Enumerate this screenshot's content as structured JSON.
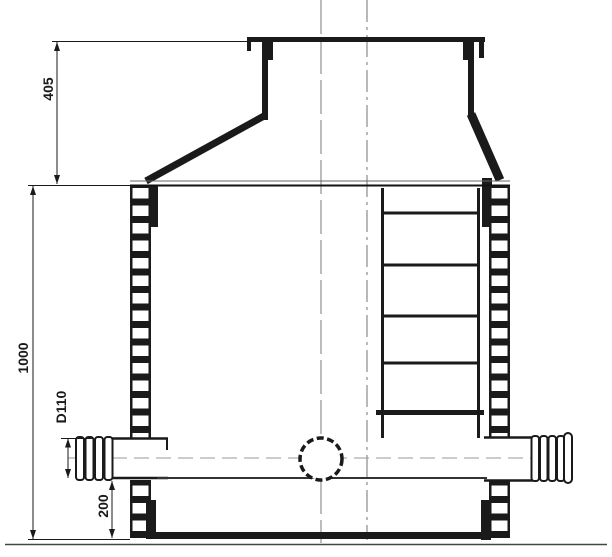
{
  "drawing": {
    "colors": {
      "line": "#1a1a1a",
      "thin_line": "#555555",
      "centerline": "#8a8a8a",
      "background": "#ffffff"
    },
    "dim_labels": {
      "cone_height": "405",
      "body_height": "1000",
      "pipe_diameter": "D110",
      "bottom_offset": "200"
    }
  }
}
